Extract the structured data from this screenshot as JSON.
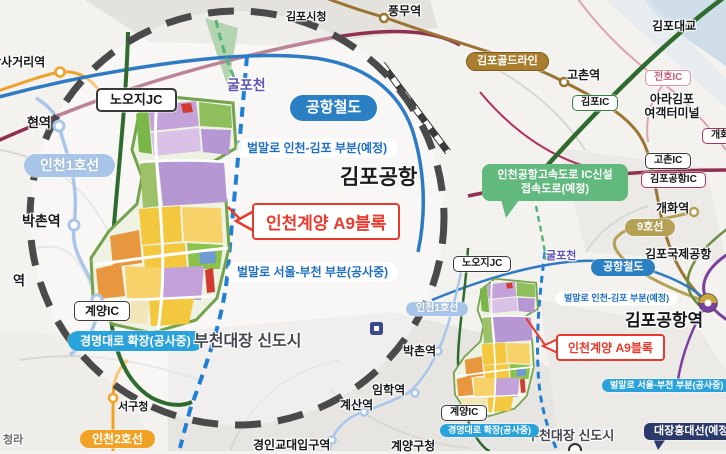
{
  "title": "인천계양 A9블록 위치도",
  "colors": {
    "accent_red": "#e8392c",
    "construction_blue": "#2aa3dd",
    "airport_rail_blue": "#2b7fc3",
    "line1_blue": "#a9c6ea",
    "line2_orange": "#f0a227",
    "goldline_brown": "#ab7d2e",
    "line9_tan": "#b4a155",
    "daejang_navy": "#2c3a6b",
    "expressway_green": "#62b97e",
    "stream_purple": "#5f52b8",
    "circle_dash_gray": "#4a4a4a"
  },
  "magnified": {
    "nooji_jc": "노오지JC",
    "gulpocheon": "굴포천",
    "airport_railroad": "공항철도",
    "beolmallo_incheon_gimpo": "벌말로 인천-김포 부분(예정)",
    "gimpo_airport": "김포공항",
    "incheon_line1": "인천1호선",
    "a9_block": "인천계양 A9블록",
    "beolmallo_seoul_bucheon": "벌말로 서울-부천 부분(공사중)",
    "bakchon_station": "박촌역",
    "gyulhyeon_station_partial": "현역",
    "imhak_station_partial": "역",
    "gyeyang_ic": "계양IC",
    "gyeongmyeong_daero": "경명대로 확장(공사중)",
    "bucheon_daejang": "부천대장 신도시"
  },
  "base": {
    "gimpo_cityhall": "김포시청",
    "pungmu_station": "풍무역",
    "gimpo_bridge": "김포대교",
    "dansageori_station": "단사거리역",
    "gimpo_goldline": "김포골드라인",
    "gochon_station": "고촌역",
    "jeonho_ic": "전호IC",
    "ara_terminal_line1": "아라김포",
    "ara_terminal_line2": "여객터미널",
    "gimpo_ic": "김포IC",
    "gaehwa_ic": "개화IC",
    "gochon_ic": "고촌IC",
    "gimpo_airport_ic": "김포공항IC",
    "expressway_callout_line1": "인천공항고속도로 IC신설",
    "expressway_callout_line2": "접속도로(예정)",
    "gaehwa_station": "개화역",
    "line9": "9호선",
    "gimpo_intl_airport": "김포국제공항",
    "gimpo_airport_station": "김포공항역",
    "gulpocheon": "굴포천",
    "airport_railroad": "공항철도",
    "beolmallo_incheon_gimpo": "벌말로 인천-김포 부분(예정)",
    "nooji_jc": "노오지JC",
    "incheon_line1": "인천1호선",
    "a9_block": "인천계양 A9블록",
    "beolmallo_seoul_bucheon": "벌말로 서울-부천 부분(공사중)",
    "bucheon_daejang": "부천대장 신도시",
    "daejang_hongdae_line": "대장홍대선(예정)",
    "gyeyang_ic": "계양IC",
    "gyeongmyeong_daero": "경명대로 확장(공사중)",
    "gyeyang_guchong": "계양구청",
    "gyesan_station": "계산역",
    "imhak_station": "임학역",
    "bakchon_station": "박촌역",
    "gyeongin_edu_station": "경인교대입구역",
    "incheon_line2": "인천2호선",
    "seogu_office": "서구청",
    "cheongna_partial": "청라"
  }
}
